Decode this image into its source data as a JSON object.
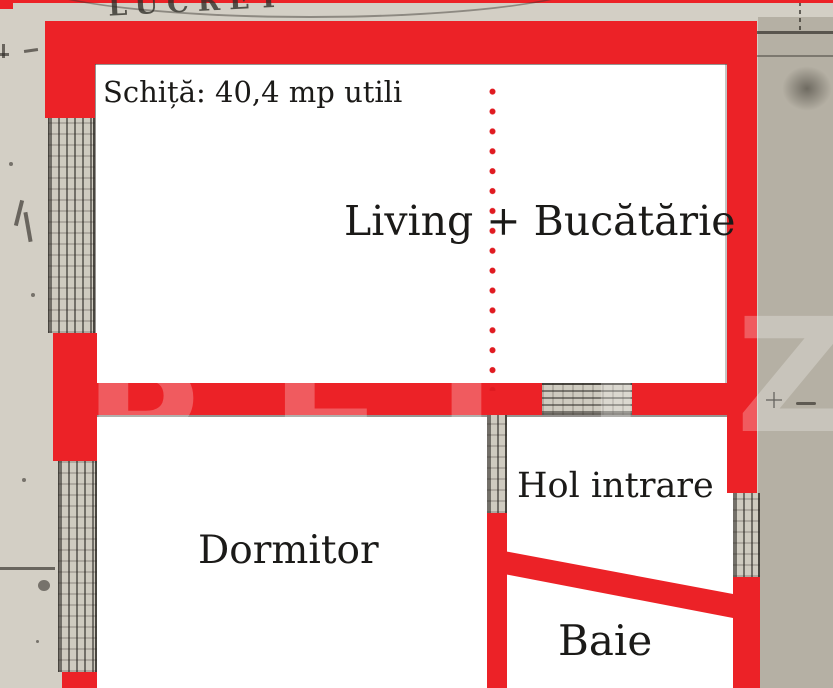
{
  "document": {
    "title": "Schiță: 40,4 mp utili"
  },
  "rooms": [
    {
      "id": "living-bucatarie",
      "label": "Living + Bucătărie"
    },
    {
      "id": "dormitor",
      "label": "Dormitor"
    },
    {
      "id": "hol-intrare",
      "label": "Hol intrare"
    },
    {
      "id": "baie",
      "label": "Baie"
    }
  ],
  "watermark": {
    "text": "BLITZ"
  },
  "background": {
    "stamp_text": "LUCRET"
  },
  "colors": {
    "wall_red": "#ec2227",
    "dot_red": "#e01b21",
    "paper_light": "#d3cfc5",
    "paper_dark": "#b5b0a4",
    "label_text": "#1b1a18"
  }
}
